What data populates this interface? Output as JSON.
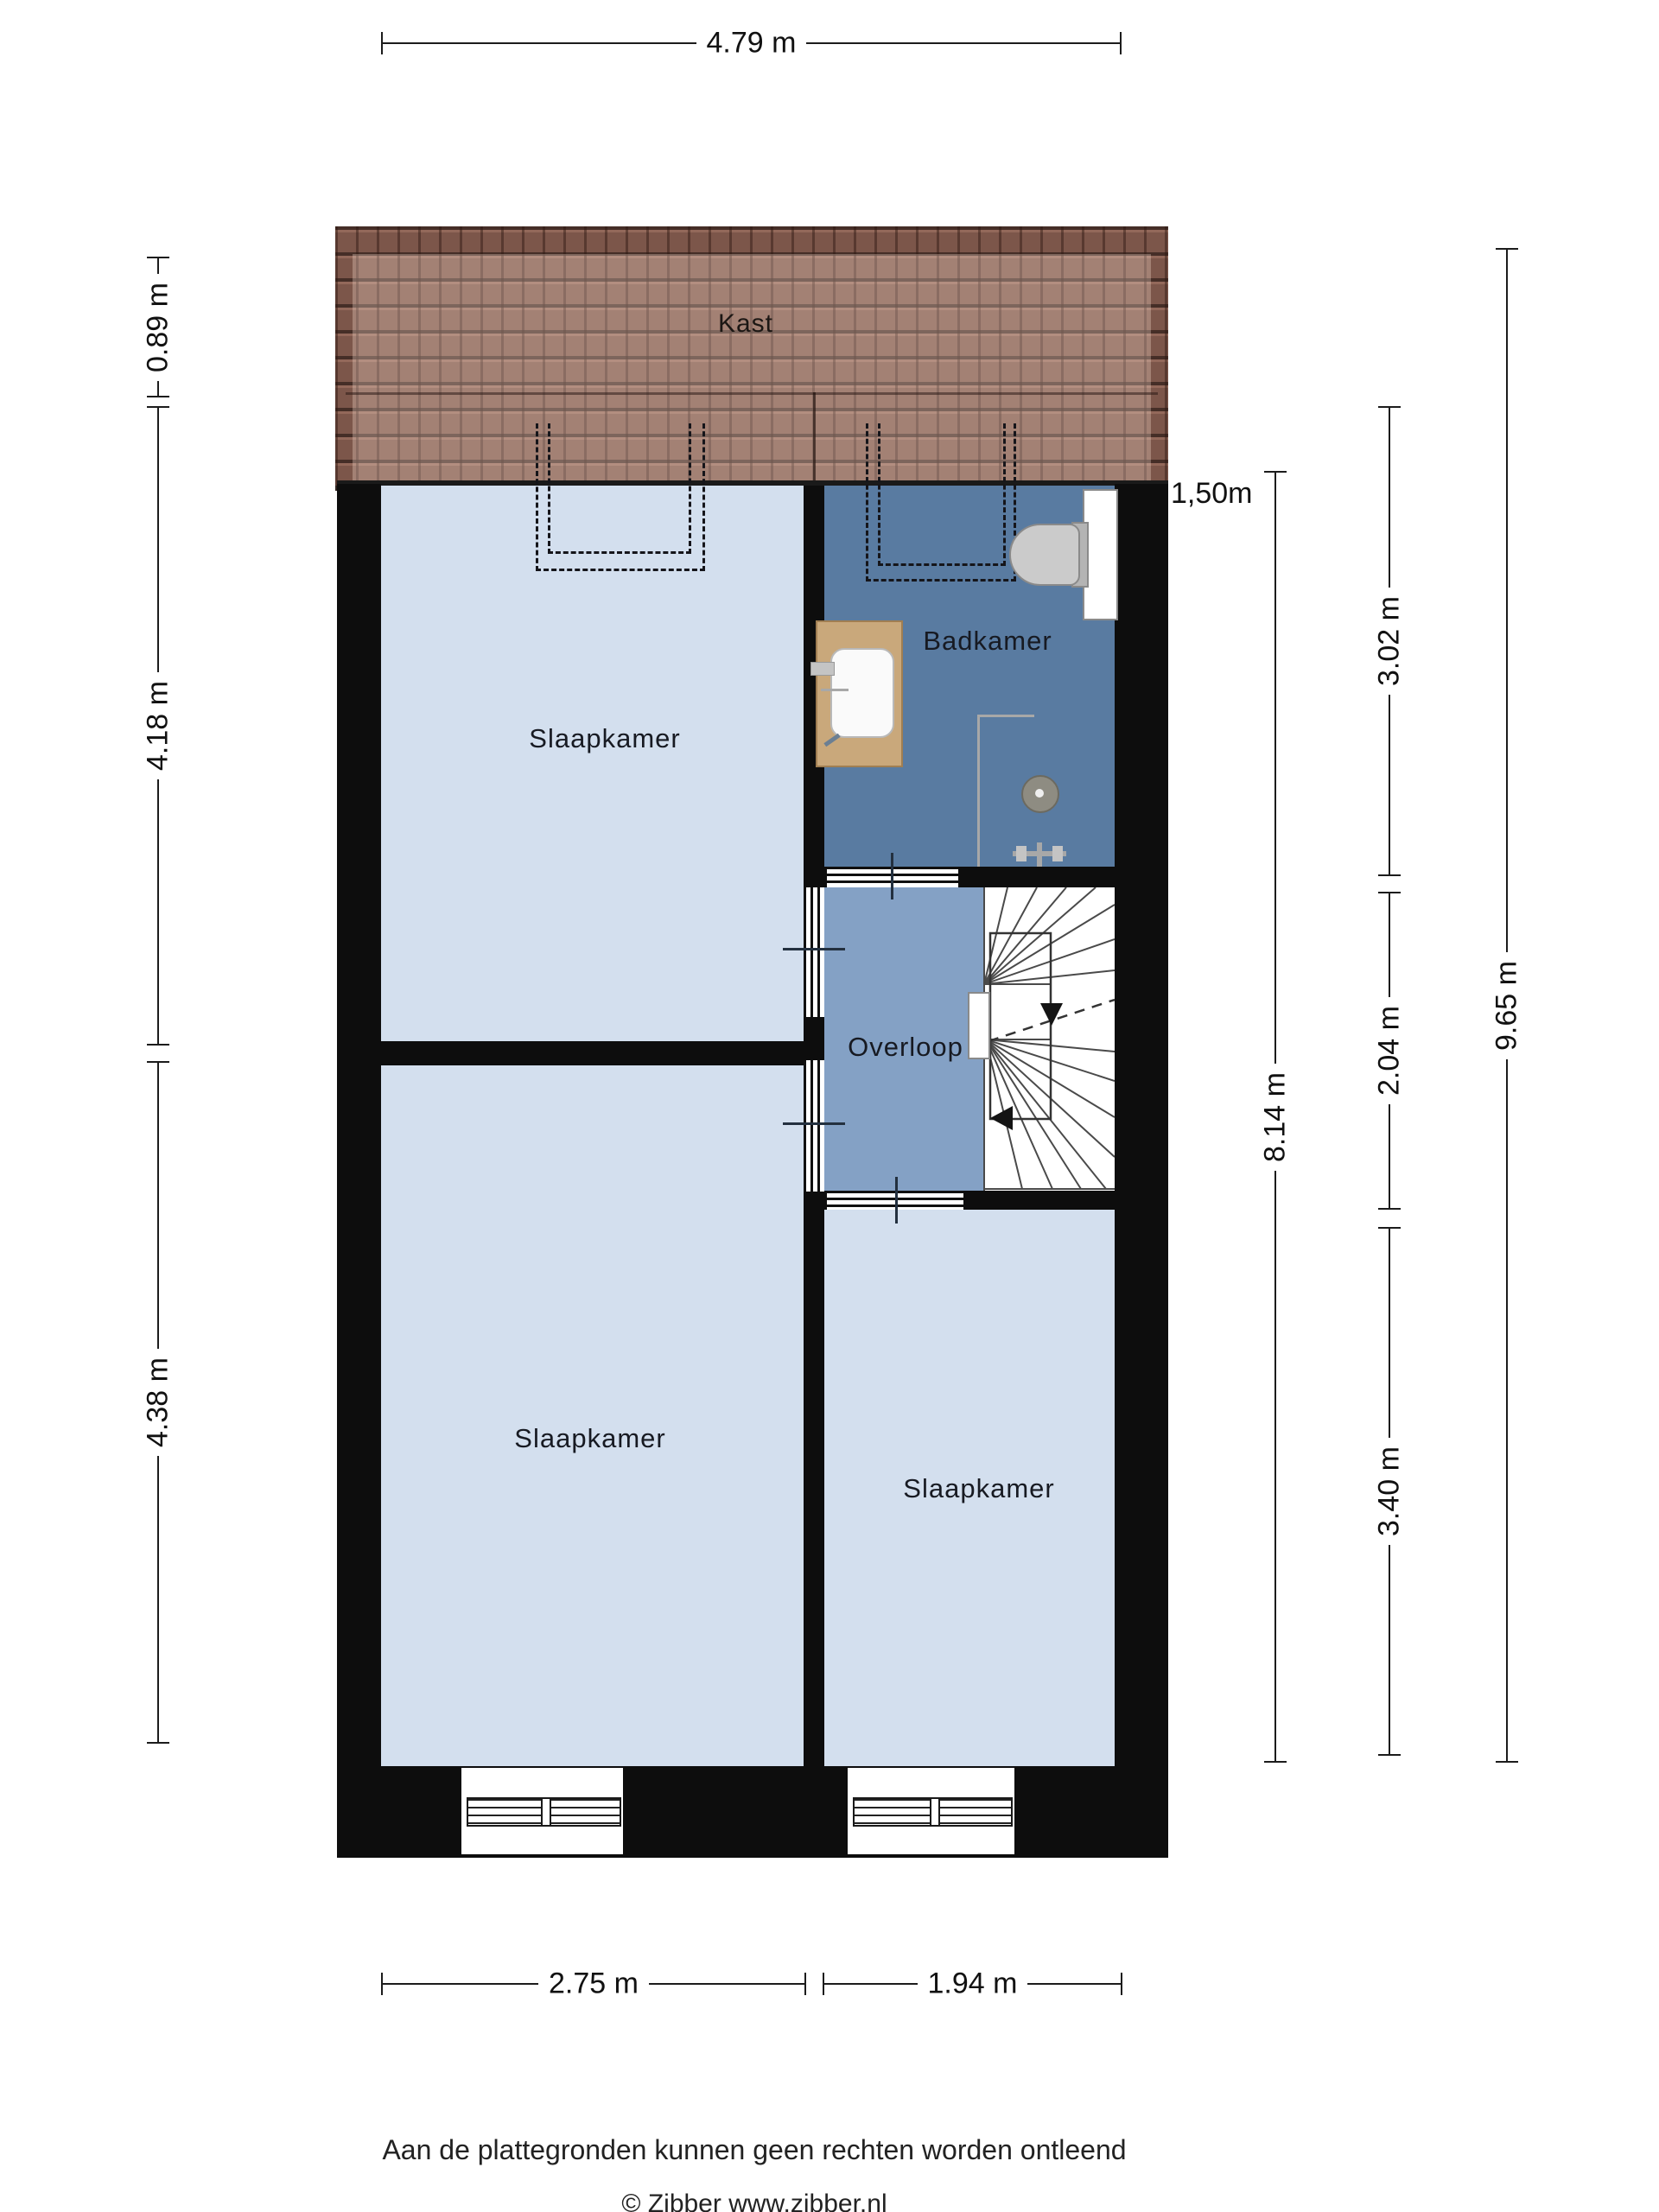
{
  "rooms": {
    "kast": "Kast",
    "slaapkamer_top": "Slaapkamer",
    "badkamer": "Badkamer",
    "overloop": "Overloop",
    "slaapkamer_bottom_left": "Slaapkamer",
    "slaapkamer_bottom_right": "Slaapkamer"
  },
  "dimensions": {
    "top_width": "4.79 m",
    "left_roof": "0.89 m",
    "left_upper": "4.18 m",
    "left_lower": "4.38 m",
    "right_roof_depth": "1,50m",
    "right_upper": "3.02 m",
    "right_middle": "2.04 m",
    "right_lower": "3.40 m",
    "right_inner_total": "8.14 m",
    "right_outer_total": "9.65 m",
    "bottom_left": "2.75 m",
    "bottom_right": "1.94 m"
  },
  "footer": {
    "disclaimer": "Aan de plattegronden kunnen geen rechten worden ontleend",
    "credit": "© Zibber www.zibber.nl"
  },
  "colors": {
    "bedroom_floor": "#d3dfee",
    "bathroom_floor": "#597ba1",
    "hallway_floor": "#84a1c5",
    "roof_tiles": "#7c564a",
    "wall": "#0d0d0d",
    "vanity_wood": "#c9a87b"
  }
}
